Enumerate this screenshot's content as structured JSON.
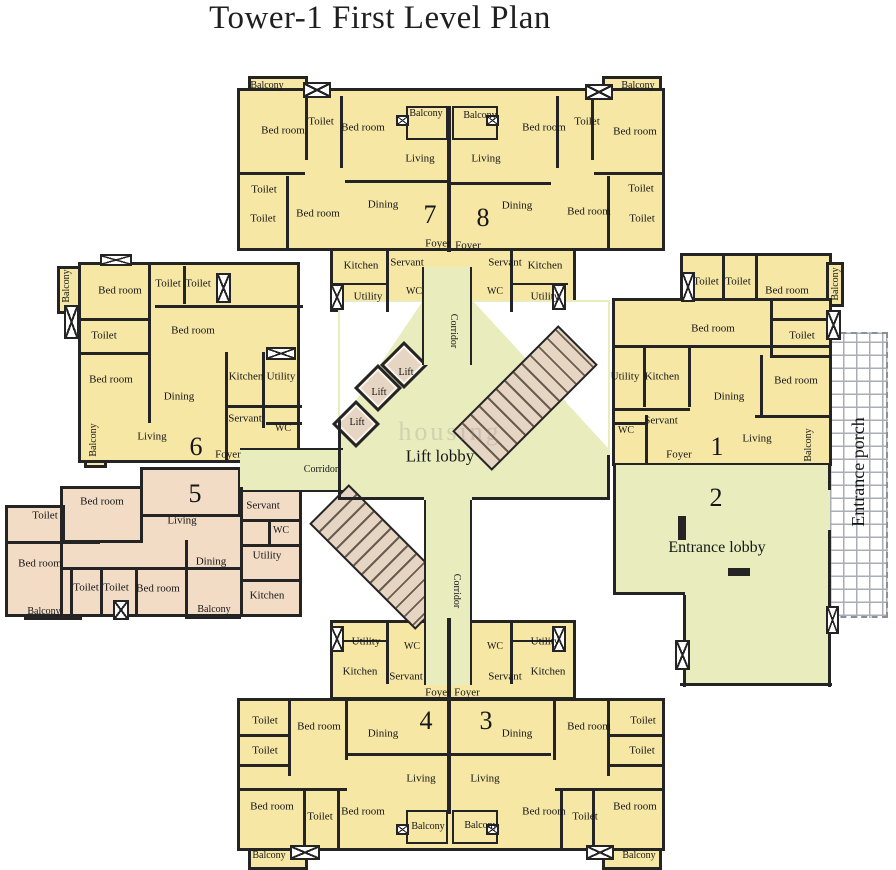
{
  "title": "Tower-1 First Level Plan",
  "watermark": "housing",
  "colors": {
    "wall": "#242424",
    "unit_fill": "#f6e7a5",
    "unit5_fill": "#f2dcc6",
    "corridor_fill": "#e9edbe",
    "stair_lift_fill": "#e6d5c2",
    "porch_grid_line": "#a9adb6",
    "label_text": "#161616"
  },
  "legend": {
    "unit_numbers": [
      "1",
      "2",
      "3",
      "4",
      "5",
      "6",
      "7",
      "8"
    ],
    "core_areas": [
      "Lift lobby",
      "Entrance lobby",
      "Entrance porch",
      "Corridor",
      "Lift"
    ],
    "room_types": [
      "Bed room",
      "Toilet",
      "Living",
      "Dining",
      "Kitchen",
      "Utility",
      "Servant",
      "WC",
      "Foyer",
      "Balcony"
    ]
  },
  "labels": [
    {
      "t": "Balcony",
      "x": 267,
      "y": 86,
      "s": 10
    },
    {
      "t": "Bed room",
      "x": 283,
      "y": 131,
      "s": 11
    },
    {
      "t": "Toilet",
      "x": 321,
      "y": 122,
      "s": 11
    },
    {
      "t": "Bed room",
      "x": 363,
      "y": 128,
      "s": 11
    },
    {
      "t": "Balcony",
      "x": 426,
      "y": 114,
      "s": 10
    },
    {
      "t": "Living",
      "x": 420,
      "y": 159,
      "s": 11
    },
    {
      "t": "Toilet",
      "x": 264,
      "y": 190,
      "s": 11
    },
    {
      "t": "Toilet",
      "x": 263,
      "y": 219,
      "s": 11
    },
    {
      "t": "Bed room",
      "x": 318,
      "y": 214,
      "s": 11
    },
    {
      "t": "Dining",
      "x": 383,
      "y": 205,
      "s": 11
    },
    {
      "t": "7",
      "x": 430,
      "y": 215,
      "s": 26
    },
    {
      "t": "Foyer",
      "x": 438,
      "y": 244,
      "s": 11
    },
    {
      "t": "Kitchen",
      "x": 361,
      "y": 266,
      "s": 11
    },
    {
      "t": "Servant",
      "x": 407,
      "y": 263,
      "s": 11
    },
    {
      "t": "WC",
      "x": 414,
      "y": 292,
      "s": 10
    },
    {
      "t": "Utility",
      "x": 368,
      "y": 297,
      "s": 11
    },
    {
      "t": "Balcony",
      "x": 480,
      "y": 116,
      "s": 10
    },
    {
      "t": "Living",
      "x": 486,
      "y": 159,
      "s": 11
    },
    {
      "t": "Bed room",
      "x": 544,
      "y": 128,
      "s": 11
    },
    {
      "t": "Toilet",
      "x": 587,
      "y": 122,
      "s": 11
    },
    {
      "t": "Bed room",
      "x": 635,
      "y": 132,
      "s": 11
    },
    {
      "t": "Balcony",
      "x": 638,
      "y": 86,
      "s": 10
    },
    {
      "t": "Foyer",
      "x": 468,
      "y": 246,
      "s": 11
    },
    {
      "t": "8",
      "x": 483,
      "y": 218,
      "s": 26
    },
    {
      "t": "Dining",
      "x": 517,
      "y": 206,
      "s": 11
    },
    {
      "t": "Bed room",
      "x": 589,
      "y": 212,
      "s": 11
    },
    {
      "t": "Toilet",
      "x": 641,
      "y": 189,
      "s": 11
    },
    {
      "t": "Toilet",
      "x": 642,
      "y": 219,
      "s": 11
    },
    {
      "t": "Servant",
      "x": 505,
      "y": 263,
      "s": 11
    },
    {
      "t": "Kitchen",
      "x": 545,
      "y": 266,
      "s": 11
    },
    {
      "t": "WC",
      "x": 495,
      "y": 292,
      "s": 10
    },
    {
      "t": "Utility",
      "x": 545,
      "y": 297,
      "s": 11
    },
    {
      "t": "Corridor",
      "x": 453,
      "y": 331,
      "s": 10,
      "r": 90
    },
    {
      "t": "Corridor",
      "x": 321,
      "y": 470,
      "s": 10
    },
    {
      "t": "Corridor",
      "x": 456,
      "y": 591,
      "s": 10,
      "r": 90
    },
    {
      "t": "Lift",
      "x": 406,
      "y": 373,
      "s": 10
    },
    {
      "t": "Lift",
      "x": 379,
      "y": 393,
      "s": 10
    },
    {
      "t": "Lift",
      "x": 357,
      "y": 423,
      "s": 10
    },
    {
      "t": "Lift lobby",
      "x": 440,
      "y": 456,
      "s": 17
    },
    {
      "t": "Balcony",
      "x": 67,
      "y": 286,
      "s": 10,
      "r": -90
    },
    {
      "t": "Bed room",
      "x": 120,
      "y": 291,
      "s": 11
    },
    {
      "t": "Toilet",
      "x": 168,
      "y": 284,
      "s": 11
    },
    {
      "t": "Toilet",
      "x": 198,
      "y": 284,
      "s": 11
    },
    {
      "t": "Bed room",
      "x": 193,
      "y": 331,
      "s": 11
    },
    {
      "t": "Toilet",
      "x": 104,
      "y": 336,
      "s": 11
    },
    {
      "t": "Bed room",
      "x": 111,
      "y": 380,
      "s": 11
    },
    {
      "t": "Kitchen",
      "x": 246,
      "y": 377,
      "s": 11
    },
    {
      "t": "Utility",
      "x": 281,
      "y": 377,
      "s": 11
    },
    {
      "t": "Dining",
      "x": 179,
      "y": 397,
      "s": 11
    },
    {
      "t": "Servant",
      "x": 245,
      "y": 419,
      "s": 11
    },
    {
      "t": "WC",
      "x": 283,
      "y": 429,
      "s": 10
    },
    {
      "t": "Balcony",
      "x": 94,
      "y": 440,
      "s": 10,
      "r": -90
    },
    {
      "t": "Living",
      "x": 152,
      "y": 437,
      "s": 11
    },
    {
      "t": "6",
      "x": 196,
      "y": 447,
      "s": 26
    },
    {
      "t": "Foyer",
      "x": 228,
      "y": 455,
      "s": 11
    },
    {
      "t": "5",
      "x": 195,
      "y": 494,
      "s": 26
    },
    {
      "t": "Bed room",
      "x": 102,
      "y": 502,
      "s": 11
    },
    {
      "t": "Toilet",
      "x": 45,
      "y": 516,
      "s": 11
    },
    {
      "t": "Living",
      "x": 182,
      "y": 521,
      "s": 11
    },
    {
      "t": "Servant",
      "x": 263,
      "y": 506,
      "s": 11
    },
    {
      "t": "WC",
      "x": 281,
      "y": 531,
      "s": 10
    },
    {
      "t": "Bed room",
      "x": 40,
      "y": 564,
      "s": 11
    },
    {
      "t": "Utility",
      "x": 267,
      "y": 556,
      "s": 11
    },
    {
      "t": "Dining",
      "x": 211,
      "y": 562,
      "s": 11
    },
    {
      "t": "Toilet",
      "x": 86,
      "y": 588,
      "s": 11
    },
    {
      "t": "Toilet",
      "x": 116,
      "y": 588,
      "s": 11
    },
    {
      "t": "Bed room",
      "x": 158,
      "y": 589,
      "s": 11
    },
    {
      "t": "Kitchen",
      "x": 267,
      "y": 596,
      "s": 11
    },
    {
      "t": "Balcony",
      "x": 44,
      "y": 612,
      "s": 10
    },
    {
      "t": "Balcony",
      "x": 214,
      "y": 610,
      "s": 10
    },
    {
      "t": "Toilet",
      "x": 706,
      "y": 282,
      "s": 11
    },
    {
      "t": "Toilet",
      "x": 738,
      "y": 282,
      "s": 11
    },
    {
      "t": "Bed room",
      "x": 787,
      "y": 291,
      "s": 11
    },
    {
      "t": "Balcony",
      "x": 836,
      "y": 284,
      "s": 10,
      "r": -90
    },
    {
      "t": "Bed room",
      "x": 713,
      "y": 329,
      "s": 11
    },
    {
      "t": "Toilet",
      "x": 802,
      "y": 336,
      "s": 11
    },
    {
      "t": "Utility",
      "x": 625,
      "y": 377,
      "s": 11
    },
    {
      "t": "Kitchen",
      "x": 662,
      "y": 377,
      "s": 11
    },
    {
      "t": "Bed room",
      "x": 796,
      "y": 381,
      "s": 11
    },
    {
      "t": "Dining",
      "x": 729,
      "y": 397,
      "s": 11
    },
    {
      "t": "Servant",
      "x": 661,
      "y": 421,
      "s": 11
    },
    {
      "t": "WC",
      "x": 626,
      "y": 431,
      "s": 10
    },
    {
      "t": "Foyer",
      "x": 679,
      "y": 455,
      "s": 11
    },
    {
      "t": "1",
      "x": 717,
      "y": 447,
      "s": 26
    },
    {
      "t": "Living",
      "x": 757,
      "y": 439,
      "s": 11
    },
    {
      "t": "Balcony",
      "x": 809,
      "y": 445,
      "s": 10,
      "r": -90
    },
    {
      "t": "2",
      "x": 716,
      "y": 498,
      "s": 26
    },
    {
      "t": "Entrance lobby",
      "x": 717,
      "y": 548,
      "s": 16
    },
    {
      "t": "Entrance porch",
      "x": 858,
      "y": 472,
      "s": 18,
      "r": -90
    },
    {
      "t": "Utility",
      "x": 366,
      "y": 642,
      "s": 11
    },
    {
      "t": "WC",
      "x": 412,
      "y": 647,
      "s": 10
    },
    {
      "t": "Kitchen",
      "x": 360,
      "y": 672,
      "s": 11
    },
    {
      "t": "Servant",
      "x": 406,
      "y": 677,
      "s": 11
    },
    {
      "t": "Foyer",
      "x": 438,
      "y": 693,
      "s": 11
    },
    {
      "t": "4",
      "x": 426,
      "y": 721,
      "s": 26
    },
    {
      "t": "Dining",
      "x": 383,
      "y": 734,
      "s": 11
    },
    {
      "t": "Toilet",
      "x": 265,
      "y": 721,
      "s": 11
    },
    {
      "t": "Bed room",
      "x": 319,
      "y": 727,
      "s": 11
    },
    {
      "t": "Toilet",
      "x": 265,
      "y": 751,
      "s": 11
    },
    {
      "t": "Living",
      "x": 421,
      "y": 779,
      "s": 11
    },
    {
      "t": "Bed room",
      "x": 272,
      "y": 807,
      "s": 11
    },
    {
      "t": "Toilet",
      "x": 320,
      "y": 817,
      "s": 11
    },
    {
      "t": "Bed room",
      "x": 363,
      "y": 812,
      "s": 11
    },
    {
      "t": "Balcony",
      "x": 269,
      "y": 856,
      "s": 10
    },
    {
      "t": "Balcony",
      "x": 428,
      "y": 827,
      "s": 10
    },
    {
      "t": "Foyer",
      "x": 467,
      "y": 693,
      "s": 11
    },
    {
      "t": "3",
      "x": 486,
      "y": 721,
      "s": 26
    },
    {
      "t": "Dining",
      "x": 517,
      "y": 734,
      "s": 11
    },
    {
      "t": "Servant",
      "x": 505,
      "y": 677,
      "s": 11
    },
    {
      "t": "WC",
      "x": 495,
      "y": 647,
      "s": 10
    },
    {
      "t": "Kitchen",
      "x": 548,
      "y": 672,
      "s": 11
    },
    {
      "t": "Utility",
      "x": 545,
      "y": 642,
      "s": 11
    },
    {
      "t": "Bed room",
      "x": 589,
      "y": 727,
      "s": 11
    },
    {
      "t": "Toilet",
      "x": 643,
      "y": 721,
      "s": 11
    },
    {
      "t": "Toilet",
      "x": 642,
      "y": 751,
      "s": 11
    },
    {
      "t": "Living",
      "x": 485,
      "y": 779,
      "s": 11
    },
    {
      "t": "Bed room",
      "x": 544,
      "y": 812,
      "s": 11
    },
    {
      "t": "Toilet",
      "x": 585,
      "y": 817,
      "s": 11
    },
    {
      "t": "Bed room",
      "x": 635,
      "y": 807,
      "s": 11
    },
    {
      "t": "Balcony",
      "x": 481,
      "y": 826,
      "s": 10
    },
    {
      "t": "Balcony",
      "x": 639,
      "y": 856,
      "s": 10
    }
  ]
}
